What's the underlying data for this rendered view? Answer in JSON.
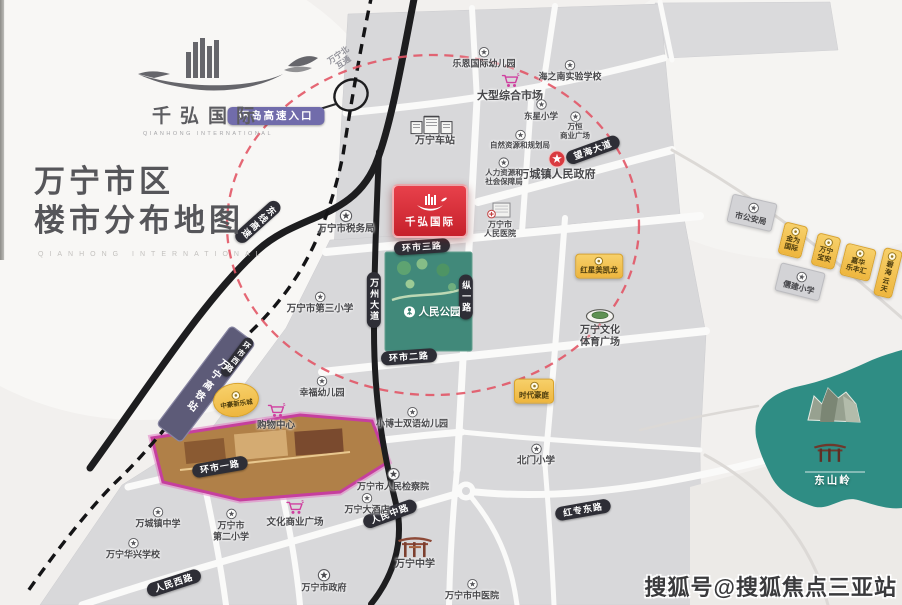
{
  "brand": {
    "logo_text": "千弘国际",
    "logo_sub": "QIANHONG INTERNATIONAL",
    "title_line1": "万宁市区",
    "title_line2": "楼市分布地图",
    "faint_caption": "QIANHONG INTERNATIONAL"
  },
  "project": {
    "label": "千弘国际"
  },
  "park": {
    "label": "人民公园"
  },
  "hsr": {
    "label": "万宁高铁站"
  },
  "dongshanling": {
    "label": "东山岭"
  },
  "watermark": "搜狐号@搜狐焦点三亚站",
  "colors": {
    "accent_red": "#d8232e",
    "park_green": "#41897a",
    "hill_teal": "#2f8d84",
    "highway_black": "#1d1d1f",
    "pill_dark": "#2e2e36",
    "pill_purple": "#716cab",
    "hsr_purple": "#5d5b78",
    "project_yellow": "#f2c14e",
    "mall_pink": "#c63f9e",
    "dashed_circle_red": "#e25766"
  },
  "road_pills": [
    {
      "name": "ring-expressway-entrance",
      "label": "环岛高速入口",
      "x": 276,
      "y": 116,
      "rot": 0,
      "kind": "purple"
    },
    {
      "name": "wanningbei-interchange",
      "label": "万宁北\n互通",
      "x": 341,
      "y": 59,
      "rot": -35,
      "kind": "plain"
    },
    {
      "name": "dongxian-expressway",
      "label": "东线高速",
      "x": 258,
      "y": 222,
      "rot": 48,
      "kind": "dark",
      "vertical": true
    },
    {
      "name": "wanzhou-avenue",
      "label": "万州大道",
      "x": 374,
      "y": 300,
      "rot": 0,
      "kind": "dark",
      "vertical": true
    },
    {
      "name": "huanshi-3rd-road",
      "label": "环市三路",
      "x": 422,
      "y": 247,
      "rot": -4,
      "kind": "dark"
    },
    {
      "name": "zongyi-road",
      "label": "纵一路",
      "x": 466,
      "y": 297,
      "rot": 0,
      "kind": "dark",
      "vertical": true
    },
    {
      "name": "huanshi-2nd-road",
      "label": "环市二路",
      "x": 409,
      "y": 357,
      "rot": -4,
      "kind": "dark"
    },
    {
      "name": "huanshi-1st-road",
      "label": "环市一路",
      "x": 220,
      "y": 467,
      "rot": -10,
      "kind": "dark"
    },
    {
      "name": "huanshi-west-road",
      "label": "环市西路",
      "x": 237,
      "y": 357,
      "rot": 37,
      "kind": "dark",
      "vertical": true,
      "small": true
    },
    {
      "name": "renmin-west-road",
      "label": "人民西路",
      "x": 174,
      "y": 583,
      "rot": -18,
      "kind": "dark"
    },
    {
      "name": "renmin-middle-road",
      "label": "人民中路",
      "x": 390,
      "y": 514,
      "rot": -20,
      "kind": "dark"
    },
    {
      "name": "hongzhuan-east-road",
      "label": "红专东路",
      "x": 583,
      "y": 510,
      "rot": -10,
      "kind": "dark"
    },
    {
      "name": "wanghai-avenue",
      "label": "望海大道",
      "x": 593,
      "y": 150,
      "rot": -20,
      "kind": "dark"
    }
  ],
  "pois": [
    {
      "name": "leen-intl-kindergarten",
      "icon": "school",
      "label": "乐恩国际幼儿园",
      "x": 484,
      "y": 58,
      "fs": 9
    },
    {
      "name": "comprehensive-market",
      "icon": "cart",
      "label": "大型综合市场",
      "x": 510,
      "y": 88,
      "fs": 11
    },
    {
      "name": "haizhinan-experimental-school",
      "icon": "school",
      "label": "海之南实验学校",
      "x": 570,
      "y": 71,
      "fs": 9
    },
    {
      "name": "dongxing-primary-school",
      "icon": "school",
      "label": "东星小学",
      "x": 541,
      "y": 110,
      "fs": 8.5
    },
    {
      "name": "wanheng-commercial-plaza",
      "icon": "school",
      "label": "万恒\n商业广场",
      "x": 575,
      "y": 126,
      "fs": 7.5
    },
    {
      "name": "wanning-bus-station",
      "icon": "station",
      "label": "万宁车站",
      "x": 435,
      "y": 131,
      "fs": 10
    },
    {
      "name": "natural-resources-bureau",
      "icon": "school",
      "label": "自然资源和规划局",
      "x": 520,
      "y": 140,
      "fs": 7.5
    },
    {
      "name": "wancheng-town-government",
      "icon": "redstar",
      "label": "万城镇人民政府",
      "x": 557,
      "y": 166,
      "fs": 11
    },
    {
      "name": "hr-social-security-bureau",
      "icon": "school",
      "label": "人力资源和\n社会保障局",
      "x": 504,
      "y": 172,
      "fs": 7.5
    },
    {
      "name": "tax-bureau",
      "icon": "star",
      "label": "万宁市税务局",
      "x": 346,
      "y": 222,
      "fs": 9.5
    },
    {
      "name": "peoples-hospital",
      "icon": "hospital",
      "label": "万宁市\n人民医院",
      "x": 500,
      "y": 219,
      "fs": 8
    },
    {
      "name": "no3-primary-school",
      "icon": "school",
      "label": "万宁市第三小学",
      "x": 320,
      "y": 303,
      "fs": 9.5
    },
    {
      "name": "hongxing-meikailong",
      "icon": "dot",
      "label": "红星美凯龙",
      "x": 599,
      "y": 266,
      "kind": "yellow",
      "fs": 7.5
    },
    {
      "name": "culture-sports-plaza",
      "icon": "stadium",
      "label": "万宁文化\n体育广场",
      "x": 600,
      "y": 328,
      "fs": 10
    },
    {
      "name": "public-security-bureau",
      "icon": "school",
      "label": "市公安局",
      "x": 752,
      "y": 213,
      "kind": "gray",
      "rot": 13,
      "fs": 8
    },
    {
      "name": "project-jinwei-intl",
      "icon": "dot",
      "label": "金为\n国际",
      "x": 793,
      "y": 240,
      "kind": "yellow",
      "rot": 14,
      "fs": 7
    },
    {
      "name": "project-wanning-baoan",
      "icon": "dot",
      "label": "万宁\n宝安",
      "x": 826,
      "y": 251,
      "kind": "yellow",
      "rot": 14,
      "fs": 7
    },
    {
      "name": "project-jiahua-lefenghui",
      "icon": "dot",
      "label": "嘉华\n乐丰汇",
      "x": 858,
      "y": 262,
      "kind": "yellow",
      "rot": 14,
      "fs": 7
    },
    {
      "name": "project-bihai-yuntian",
      "icon": "dot",
      "label": "碧海\n云天",
      "x": 888,
      "y": 273,
      "kind": "yellow",
      "rot": 14,
      "fs": 7
    },
    {
      "name": "rujian-primary-school",
      "icon": "school",
      "label": "儒建小学",
      "x": 800,
      "y": 282,
      "kind": "gray",
      "rot": 14,
      "fs": 8
    },
    {
      "name": "times-mansion",
      "icon": "dot",
      "label": "时代豪庭",
      "x": 534,
      "y": 391,
      "kind": "yellow",
      "fs": 7.5
    },
    {
      "name": "xingfu-kindergarten",
      "icon": "school",
      "label": "幸福幼儿园",
      "x": 322,
      "y": 387,
      "fs": 9
    },
    {
      "name": "shopping-center",
      "icon": "cart",
      "label": "购物中心",
      "x": 276,
      "y": 417,
      "fs": 9.5
    },
    {
      "name": "zhonghao-xinlecheng",
      "icon": "dot",
      "label": "中豪新乐城",
      "x": 236,
      "y": 400,
      "kind": "yellow-round",
      "rot": -8,
      "fs": 6.5
    },
    {
      "name": "xiaoboshi-bilingual-kindergarten",
      "icon": "school",
      "label": "小博士双语幼儿园",
      "x": 412,
      "y": 418,
      "fs": 9
    },
    {
      "name": "beimen-primary-school",
      "icon": "school",
      "label": "北门小学",
      "x": 536,
      "y": 455,
      "fs": 9.5
    },
    {
      "name": "peoples-procuratorate",
      "icon": "star",
      "label": "万宁市人民检察院",
      "x": 393,
      "y": 480,
      "fs": 9
    },
    {
      "name": "culture-commercial-plaza",
      "icon": "cart",
      "label": "文化商业广场",
      "x": 295,
      "y": 514,
      "fs": 9.5
    },
    {
      "name": "wanning-hotel",
      "icon": "school",
      "label": "万宁大酒店",
      "x": 367,
      "y": 504,
      "fs": 9
    },
    {
      "name": "wancheng-middle-school",
      "icon": "school",
      "label": "万城镇中学",
      "x": 158,
      "y": 518,
      "fs": 9
    },
    {
      "name": "no2-primary-school",
      "icon": "school",
      "label": "万宁市\n第二小学",
      "x": 231,
      "y": 525,
      "fs": 9
    },
    {
      "name": "huaxing-school",
      "icon": "school",
      "label": "万宁华兴学校",
      "x": 133,
      "y": 549,
      "fs": 9
    },
    {
      "name": "city-government",
      "icon": "star",
      "label": "万宁市政府",
      "x": 324,
      "y": 581,
      "fs": 9
    },
    {
      "name": "wanning-middle-school",
      "icon": "gate",
      "label": "万宁中学",
      "x": 415,
      "y": 552,
      "fs": 10
    },
    {
      "name": "tcm-hospital",
      "icon": "school",
      "label": "万宁市中医院",
      "x": 472,
      "y": 590,
      "fs": 9
    }
  ]
}
